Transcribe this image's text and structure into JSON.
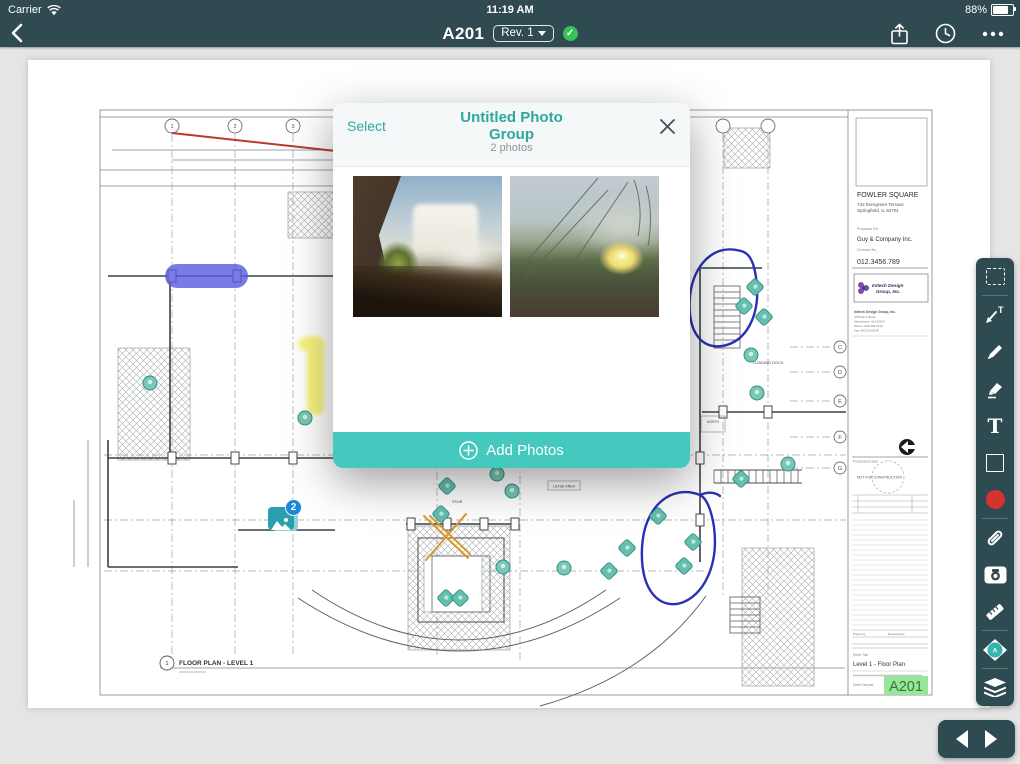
{
  "status_bar": {
    "carrier": "Carrier",
    "time": "11:19 AM",
    "battery": "88%"
  },
  "nav_bar": {
    "title": "A201",
    "revision": "Rev. 1"
  },
  "modal": {
    "select_label": "Select",
    "title": "Untitled Photo Group",
    "photo_count": "2 photos",
    "add_photos_label": "Add Photos",
    "photos": [
      {
        "name": "Waterfall photo"
      },
      {
        "name": "Flower photo"
      }
    ]
  },
  "photo_group_marker": {
    "badge_count": "2"
  },
  "toolbar": {
    "tools": [
      "marquee-select",
      "callout",
      "pen",
      "highlighter",
      "text",
      "shape",
      "color-red",
      "hyperlink",
      "camera",
      "measure",
      "photo-pin (selected)",
      "layers"
    ]
  },
  "sheet": {
    "grid_top": [
      "1",
      "2",
      "3"
    ],
    "grid_right": [
      "C",
      "D",
      "E",
      "F",
      "G"
    ],
    "labels": {
      "loading_dock": "LOADING DOCK",
      "lease_area": "LEASE AREA",
      "stair": "STAIR",
      "north": "NORTH"
    },
    "footer": {
      "detail_number": "1",
      "title": "FLOOR PLAN - LEVEL 1"
    },
    "title_block": {
      "project_name": "FOWLER SQUARE",
      "project_address_1": "742 Evergreen Terrace",
      "project_address_2": "Springfield, IL 62701",
      "prepared_for_label": "Prepared For",
      "client": "Guy & Company Inc.",
      "contract_label": "Contract No.",
      "contract_number": "012.3456.789",
      "firm_logo_line_1": "Initech Design",
      "firm_logo_line_2": "Group, Inc.",
      "firm_name": "Initech Design Group, Inc.",
      "firm_address_1": "4750 Elm Street",
      "firm_address_2": "Manchester, NH 03104",
      "firm_phone": "Phone: 603.625.6210",
      "firm_fax": "Fax: 603.218.8140",
      "seal_label": "Professional Seal",
      "seal_text": "NOT FOR CONSTRUCTION",
      "drawn_by_label": "Drawn by",
      "reviewed_by_label": "Reviewed by",
      "sheet_title_label": "Sheet Title",
      "sheet_title": "Level 1 - Floor Plan",
      "sheet_number_label": "Sheet Number",
      "sheet_number": "A201"
    }
  },
  "annotations": {
    "markers": [
      {
        "type": "diamond",
        "x": 755,
        "y": 287
      },
      {
        "type": "diamond",
        "x": 744,
        "y": 306
      },
      {
        "type": "diamond",
        "x": 764,
        "y": 317
      },
      {
        "type": "diamond",
        "x": 741,
        "y": 479
      },
      {
        "type": "diamond",
        "x": 658,
        "y": 516
      },
      {
        "type": "diamond",
        "x": 693,
        "y": 542
      },
      {
        "type": "diamond",
        "x": 627,
        "y": 548
      },
      {
        "type": "diamond",
        "x": 684,
        "y": 566
      },
      {
        "type": "diamond",
        "x": 609,
        "y": 571
      },
      {
        "type": "diamond",
        "x": 447,
        "y": 486
      },
      {
        "type": "diamond",
        "x": 441,
        "y": 514
      },
      {
        "type": "diamond",
        "x": 446,
        "y": 598
      },
      {
        "type": "diamond",
        "x": 460,
        "y": 598
      },
      {
        "type": "circle",
        "x": 305,
        "y": 418
      },
      {
        "type": "circle",
        "x": 497,
        "y": 474
      },
      {
        "type": "circle",
        "x": 512,
        "y": 491
      },
      {
        "type": "circle",
        "x": 503,
        "y": 567
      },
      {
        "type": "circle",
        "x": 564,
        "y": 568
      },
      {
        "type": "circle",
        "x": 751,
        "y": 355
      },
      {
        "type": "circle",
        "x": 757,
        "y": 393
      },
      {
        "type": "circle",
        "x": 788,
        "y": 464
      },
      {
        "type": "circle",
        "x": 150,
        "y": 383
      }
    ]
  },
  "colors": {
    "nav_bg": "#2f4b51",
    "accent_teal": "#45c8bd",
    "title_teal": "#2ea79e",
    "marker_teal": "#63bfae",
    "badge_blue": "#1d87d8",
    "ink_blue": "#2831b5",
    "annotation_red": "#b83a2e",
    "annotation_orange": "#d9982e",
    "highlight_purple": "#5a5ae0",
    "highlight_yellow": "#f7ee3c",
    "sheet_number_highlight": "#99e69b",
    "sync_green": "#35c257"
  }
}
